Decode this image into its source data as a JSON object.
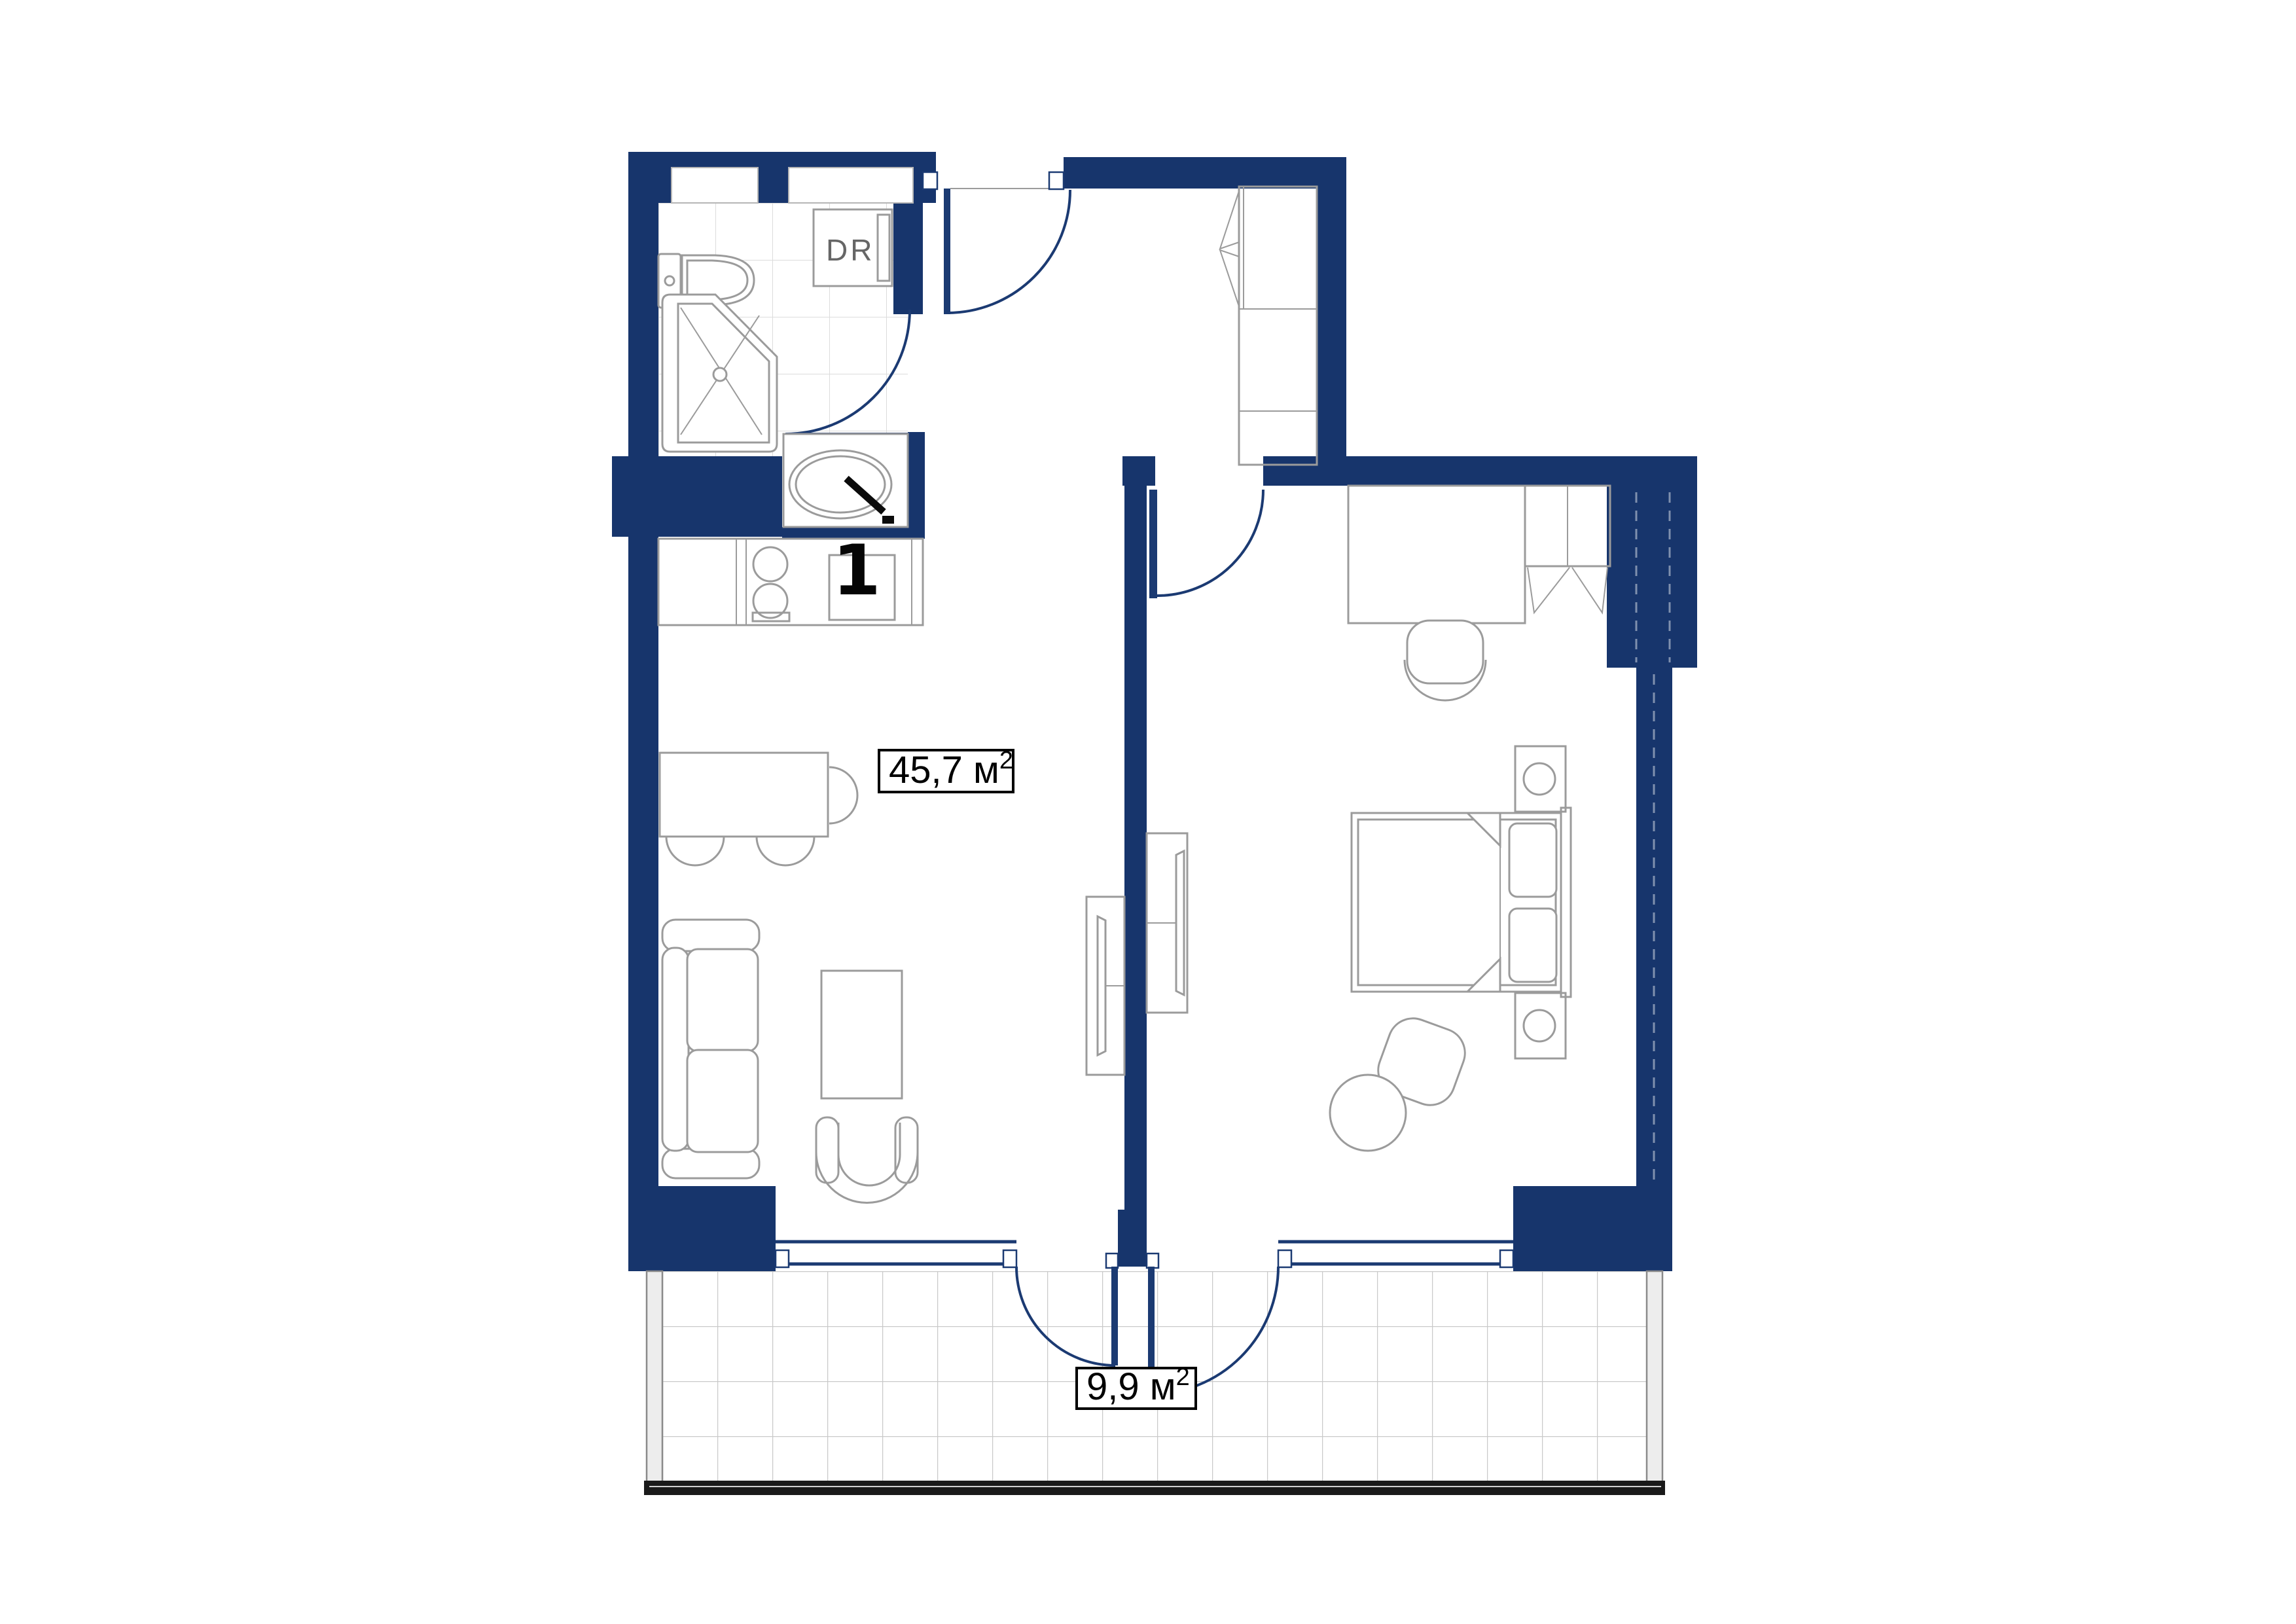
{
  "colors": {
    "wall": "#17356c",
    "door": "#1b3a72",
    "line": "#9b9b9b",
    "tile": "#dcdcdc",
    "tileBalcony": "#c9c9c9",
    "ink": "#000000",
    "drText": "#666666",
    "railing": "#1a1a1a",
    "glassFill": "#ededed",
    "glassEdge": "#8a8a8a"
  },
  "labels": {
    "apartment_number": "1",
    "dryer": "DR",
    "main_area": {
      "text": "45,7 м",
      "sup": "2"
    },
    "balcony_area": {
      "text": "9,9 м",
      "sup": "2"
    }
  }
}
